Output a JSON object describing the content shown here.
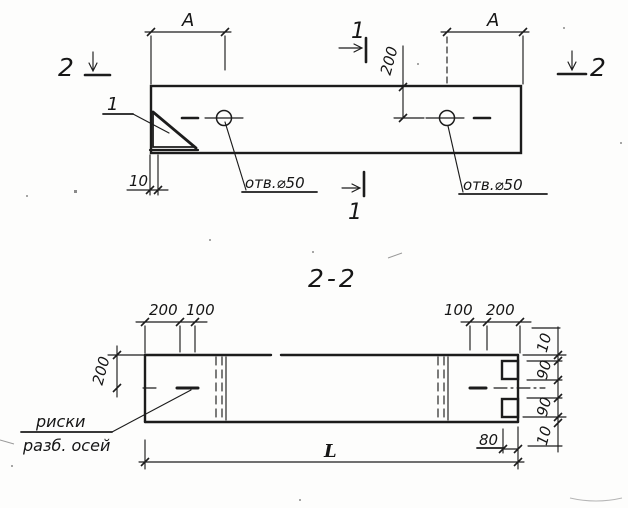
{
  "drawing": {
    "plan_view": {
      "span_label_left": "А",
      "span_label_right": "А",
      "section_cut_1_top": "1",
      "section_cut_1_bottom": "1",
      "section_cut_2_left": "2",
      "section_cut_2_right": "2",
      "hole_offset_dim": "200",
      "chamfer_dim": "10",
      "chamfer_detail_ref": "1",
      "hole_label_left": "отв.⌀50",
      "hole_label_right": "отв.⌀50"
    },
    "section_view": {
      "title": "2-2",
      "top_dims_left": [
        "200",
        "100"
      ],
      "top_dims_right": [
        "100",
        "200"
      ],
      "side_dim": "200",
      "right_dims": [
        "10",
        "90",
        "90",
        "10"
      ],
      "end_dim": "80",
      "length_dim": "L",
      "note_line1": "риски",
      "note_line2": "разб. осей"
    }
  }
}
